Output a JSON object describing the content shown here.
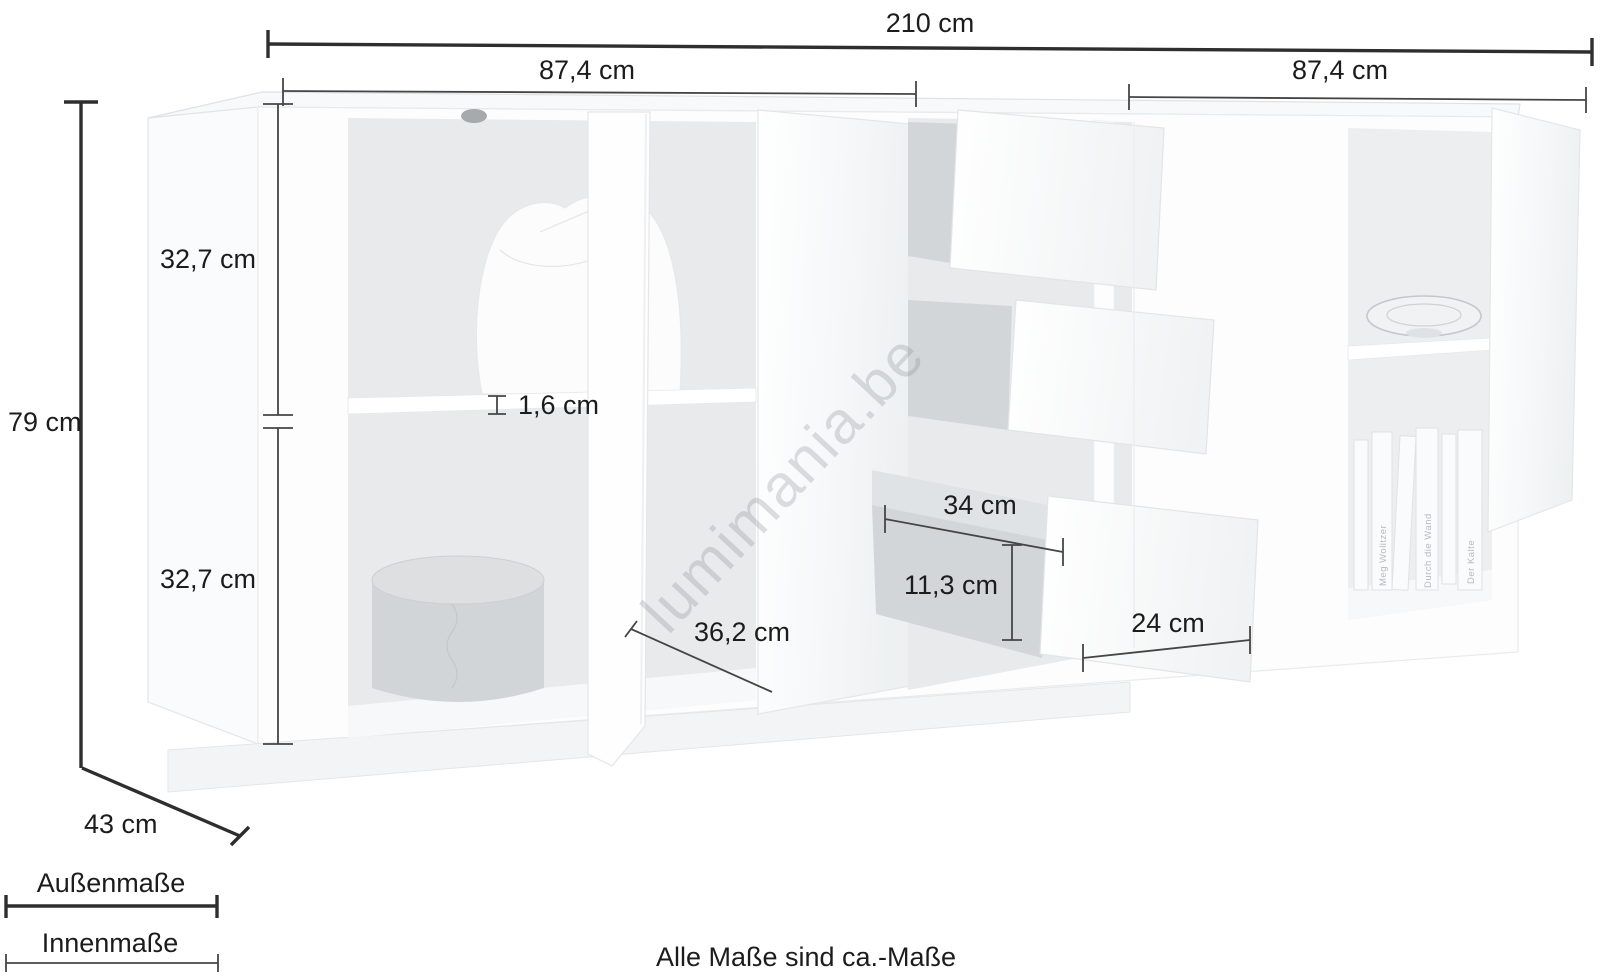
{
  "page": {
    "footnote": "Alle Maße sind ca.-Maße",
    "watermark": "lumimania.be"
  },
  "colors": {
    "background": "#ffffff",
    "outer_dimension_line": "#2e2e2e",
    "inner_dimension_line": "#454545",
    "label_text": "#1c1c1c",
    "interior_gray": "#e8eaec",
    "watermark_gray": "#7d848a"
  },
  "legend": {
    "outer": {
      "label": "Außenmaße",
      "style": "thick-line"
    },
    "inner": {
      "label": "Innenmaße",
      "style": "thin-line"
    }
  },
  "dimensions": {
    "total_width": {
      "label": "210 cm",
      "type": "outer"
    },
    "left_section_width": {
      "label": "87,4 cm",
      "type": "inner"
    },
    "right_section_width": {
      "label": "87,4 cm",
      "type": "inner"
    },
    "height": {
      "label": "79 cm",
      "type": "outer"
    },
    "upper_compartment_height": {
      "label": "32,7 cm",
      "type": "inner"
    },
    "lower_compartment_height": {
      "label": "32,7 cm",
      "type": "inner"
    },
    "shelf_thickness": {
      "label": "1,6 cm",
      "type": "inner"
    },
    "door_width": {
      "label": "36,2 cm",
      "type": "inner"
    },
    "drawer_inner_depth": {
      "label": "34 cm",
      "type": "inner"
    },
    "drawer_inner_height": {
      "label": "11,3 cm",
      "type": "inner"
    },
    "drawer_front_width": {
      "label": "24 cm",
      "type": "inner"
    },
    "depth": {
      "label": "43 cm",
      "type": "outer"
    }
  },
  "decor": {
    "books": [
      {
        "title": "Meg Wolitzer"
      },
      {
        "title": "Durch die Wand"
      },
      {
        "title": "Der Kalte"
      }
    ]
  }
}
